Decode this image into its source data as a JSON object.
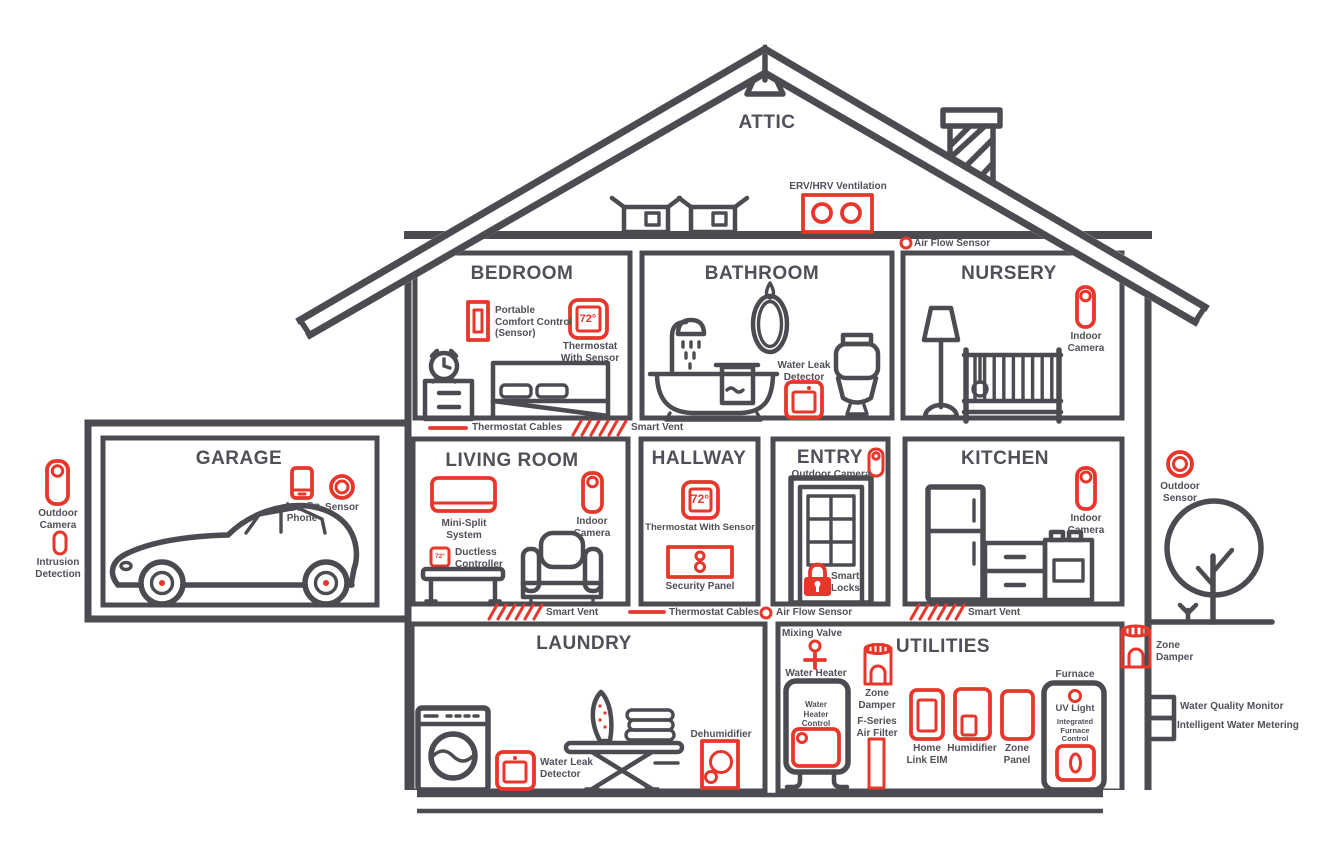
{
  "colors": {
    "line": "#4b4b52",
    "accent": "#e8362b",
    "text": "#50505a"
  },
  "rooms": {
    "attic": "ATTIC",
    "bedroom": "BEDROOM",
    "bathroom": "BATHROOM",
    "nursery": "NURSERY",
    "garage": "GARAGE",
    "living_room": "LIVING ROOM",
    "hallway": "HALLWAY",
    "entry": "ENTRY",
    "kitchen": "KITCHEN",
    "laundry": "LAUNDRY",
    "utilities": "UTILITIES"
  },
  "devices": {
    "erv_hrv": "ERV/HRV Ventilation",
    "air_flow_top": "Air Flow Sensor",
    "portable_comfort": "Portable\nComfort Control\n(Sensor)",
    "thermostat_bedroom": "Thermostat\nWith Sensor",
    "water_leak_bath": "Water Leak\nDetector",
    "indoor_cam_nursery": "Indoor\nCamera",
    "outdoor_cam_left": "Outdoor\nCamera",
    "intrusion_detection": "Intrusion\nDetection",
    "app_on_phone": "App On\nPhone",
    "garage_sensor": "Sensor",
    "thermostat_cables_upper": "Thermostat Cables",
    "smart_vent_upper": "Smart Vent",
    "mini_split": "Mini-Split\nSystem",
    "indoor_cam_living": "Indoor\nCamera",
    "ductless_controller": "Ductless\nController",
    "thermostat_hall": "Thermostat With Sensor",
    "security_panel": "Security Panel",
    "outdoor_cam_entry": "Outdoor Camera",
    "smart_locks": "Smart\nLocks",
    "indoor_cam_kitchen": "Indoor\nCamera",
    "smart_vent_living": "Smart Vent",
    "thermostat_cables_lower": "Thermostat Cables",
    "air_flow_mid": "Air Flow Sensor",
    "smart_vent_kitchen": "Smart Vent",
    "outdoor_sensor": "Outdoor\nSensor",
    "zone_damper_right": "Zone\nDamper",
    "water_quality": "Water Quality Monitor",
    "water_metering": "Intelligent Water Metering",
    "mixing_valve": "Mixing Valve",
    "water_heater": "Water Heater",
    "water_heater_control": "Water\nHeater\nControl",
    "zone_damper_util": "Zone\nDamper",
    "f_series_filter": "F-Series\nAir Filter",
    "home_link_eim": "Home\nLink EIM",
    "humidifier": "Humidifier",
    "zone_panel": "Zone\nPanel",
    "furnace": "Furnace",
    "uv_light": "UV Light",
    "furnace_control": "Integrated\nFurnace\nControl",
    "water_leak_laundry": "Water Leak\nDetector",
    "dehumidifier": "Dehumidifier"
  },
  "readings": {
    "bedroom_thermostat": "72°",
    "hallway_thermostat": "72°",
    "ductless_controller": "72°"
  }
}
